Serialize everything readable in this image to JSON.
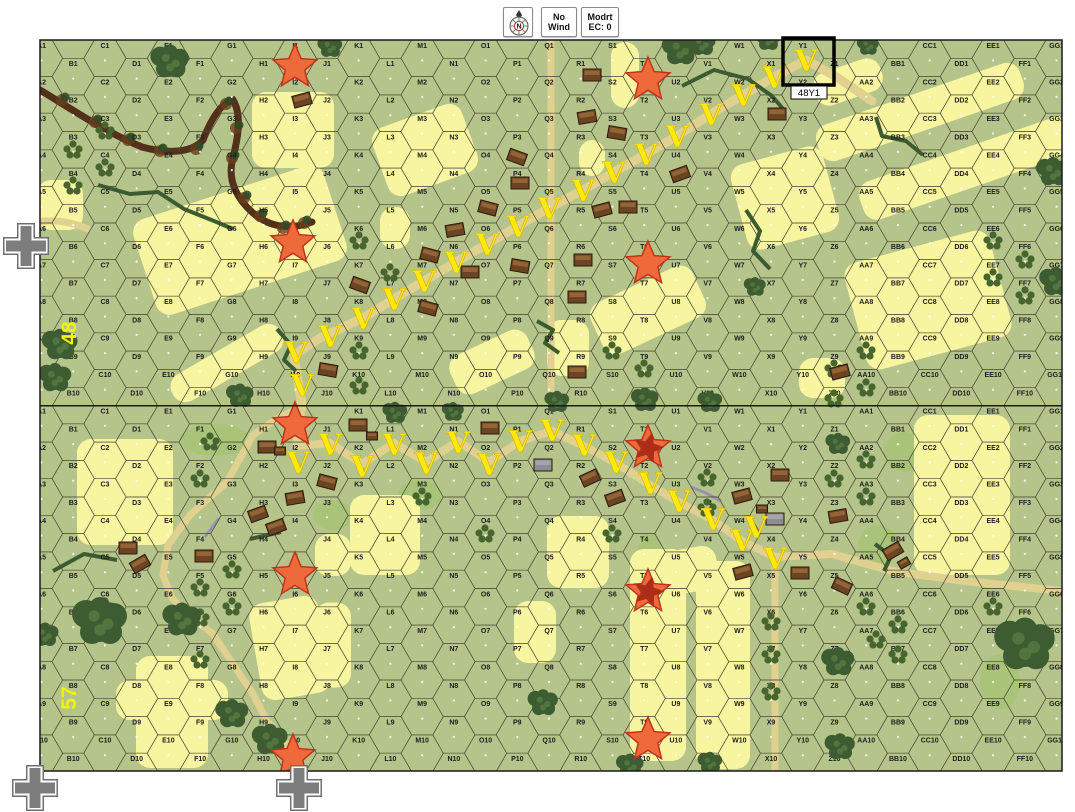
{
  "toolbar": {
    "compass_letter": "N",
    "wind": [
      "No",
      "Wind"
    ],
    "ec": [
      "Modrt",
      "EC: 0"
    ]
  },
  "map": {
    "columns": [
      "A",
      "B",
      "C",
      "D",
      "E",
      "F",
      "G",
      "H",
      "I",
      "J",
      "K",
      "L",
      "M",
      "N",
      "O",
      "P",
      "Q",
      "R",
      "S",
      "T",
      "U",
      "V",
      "W",
      "X",
      "Y",
      "Z",
      "AA",
      "BB",
      "CC",
      "DD",
      "EE",
      "FF",
      "GG"
    ],
    "rows_per_board": 10,
    "boards": [
      {
        "number": "48",
        "top": 40,
        "label_x": 76,
        "label_y": 333
      },
      {
        "number": "57",
        "top": 405.5,
        "label_x": 76,
        "label_y": 698
      }
    ],
    "geometry": {
      "left": 40,
      "col_spacing": 31.72,
      "row_height": 36.6,
      "hex_half_w": 21.15,
      "hex_half_h": 18.3,
      "width": 1022,
      "board_height": 366,
      "total_height": 731
    }
  },
  "selection": {
    "hex": "Y1",
    "label": "48Y1",
    "x": 783,
    "y": 38,
    "w": 51,
    "h": 47,
    "label_x": 791,
    "label_y": 86,
    "label_w": 36,
    "label_h": 13
  },
  "colors": {
    "page": "#ffffff",
    "base": "#b5c48a",
    "grid": "#4c4c38",
    "hex_label": "#1c1c1c",
    "grain": "#f8f5a0",
    "road": "#e0d191",
    "meadow": "#a9c478",
    "woods_dark": "#3e5c32",
    "woods_light": "#587c42",
    "orchard": "#47652f",
    "stream": "#3a5c30",
    "gully": "#53301a",
    "wall": "#9a93b0",
    "building": "#6b4423",
    "building_dark": "#2e1a0c",
    "building_roof": "#9a6a38",
    "building_gray": "#8c8c94",
    "star_fill": "#ef6a3a",
    "star_stroke": "#c2321c",
    "star_inner": "#a52815",
    "vee": "#ffe908",
    "board_label": "#f2f400",
    "selection": "#000000",
    "cross_gray": "#7d7d7d"
  },
  "terrain": {
    "fields": [
      {
        "x": 240,
        "y": 240,
        "w": 200,
        "h": 100,
        "r": -18
      },
      {
        "x": 227,
        "y": 363,
        "w": 125,
        "h": 30,
        "r": -30
      },
      {
        "x": 293,
        "y": 130,
        "w": 82,
        "h": 76,
        "r": 0
      },
      {
        "x": 60,
        "y": 205,
        "w": 46,
        "h": 50,
        "r": 0
      },
      {
        "x": 625,
        "y": 75,
        "w": 28,
        "h": 66,
        "r": 0
      },
      {
        "x": 425,
        "y": 150,
        "w": 95,
        "h": 72,
        "r": -20
      },
      {
        "x": 920,
        "y": 112,
        "w": 215,
        "h": 38,
        "r": -19
      },
      {
        "x": 968,
        "y": 168,
        "w": 225,
        "h": 40,
        "r": -19
      },
      {
        "x": 848,
        "y": 82,
        "w": 70,
        "h": 34,
        "r": -19
      },
      {
        "x": 928,
        "y": 300,
        "w": 150,
        "h": 110,
        "r": -15
      },
      {
        "x": 785,
        "y": 198,
        "w": 95,
        "h": 88,
        "r": -15
      },
      {
        "x": 648,
        "y": 310,
        "w": 112,
        "h": 56,
        "r": -25
      },
      {
        "x": 492,
        "y": 362,
        "w": 85,
        "h": 42,
        "r": -25
      },
      {
        "x": 568,
        "y": 348,
        "w": 42,
        "h": 56,
        "r": 0
      },
      {
        "x": 592,
        "y": 158,
        "w": 26,
        "h": 36,
        "r": 0
      },
      {
        "x": 822,
        "y": 378,
        "w": 46,
        "h": 40,
        "r": 0
      },
      {
        "x": 395,
        "y": 228,
        "w": 30,
        "h": 42,
        "r": 0
      },
      {
        "x": 125,
        "y": 492,
        "w": 96,
        "h": 106,
        "r": 0
      },
      {
        "x": 658,
        "y": 655,
        "w": 56,
        "h": 212,
        "r": 0
      },
      {
        "x": 723,
        "y": 665,
        "w": 54,
        "h": 208,
        "r": 0
      },
      {
        "x": 680,
        "y": 572,
        "w": 76,
        "h": 44,
        "r": -10
      },
      {
        "x": 290,
        "y": 648,
        "w": 70,
        "h": 98,
        "r": -10
      },
      {
        "x": 172,
        "y": 712,
        "w": 72,
        "h": 112,
        "r": 0
      },
      {
        "x": 172,
        "y": 700,
        "w": 112,
        "h": 40,
        "r": 0
      },
      {
        "x": 385,
        "y": 535,
        "w": 70,
        "h": 80,
        "r": 0
      },
      {
        "x": 333,
        "y": 555,
        "w": 36,
        "h": 42,
        "r": 0
      },
      {
        "x": 578,
        "y": 552,
        "w": 62,
        "h": 72,
        "r": 0
      },
      {
        "x": 962,
        "y": 495,
        "w": 96,
        "h": 160,
        "r": 0
      },
      {
        "x": 535,
        "y": 632,
        "w": 42,
        "h": 62,
        "r": 0
      },
      {
        "x": 333,
        "y": 645,
        "w": 36,
        "h": 85,
        "r": 0
      }
    ],
    "meadows": [
      [
        215,
        440,
        70,
        32
      ],
      [
        333,
        515,
        40,
        30
      ],
      [
        420,
        495,
        45,
        30
      ],
      [
        650,
        570,
        30,
        75
      ],
      [
        905,
        452,
        42,
        40
      ],
      [
        878,
        545,
        40,
        40
      ],
      [
        1000,
        682,
        40,
        55
      ]
    ],
    "roads": [
      {
        "d": "M302,406 L294,355 L320,338 L363,318 L394,299 L424,281 L456,262 L487,244 L518,226 L549,208 L583,190 L614,172 L646,154 L677,136 L711,114 L743,95 L774,77 L806,60 L838,78 L872,101",
        "w": 9
      },
      {
        "d": "M551,40 L551,406",
        "w": 7
      },
      {
        "d": "M38,222 Q62,218 88,229",
        "w": 7
      },
      {
        "d": "M302,406 L296,446 L330,443 L362,464 L394,443 L426,462 L458,441 L489,462 L520,441 L552,431 L584,446 L616,463 L650,485 L679,502 L713,520 L742,541 L775,557 L832,554 L892,571 L965,581 L1062,591",
        "w": 8
      },
      {
        "d": "M302,406 L275,420 L253,435 L227,482 L190,515 L168,545 L163,575 L172,598 L185,612 L213,634 L237,670 L253,694 L267,721 L290,748 L303,770",
        "w": 7
      },
      {
        "d": "M775,557 L775,771",
        "w": 7
      }
    ],
    "gully": "M40,90 C70,108 105,132 142,147 C168,154 192,153 203,140 C210,122 220,103 233,100 C243,116 237,142 232,162 C228,182 238,200 253,213 C268,226 288,231 312,222",
    "gully_trees": [
      [
        62,
        100
      ],
      [
        95,
        122
      ],
      [
        128,
        140
      ],
      [
        160,
        151
      ],
      [
        196,
        149
      ],
      [
        226,
        104
      ],
      [
        236,
        128
      ],
      [
        232,
        158
      ],
      [
        244,
        198
      ],
      [
        260,
        216
      ],
      [
        283,
        228
      ],
      [
        304,
        223
      ]
    ],
    "streams": [
      "M98,185 L130,194 L158,192 L184,209 L214,221 L233,229",
      "M682,86 L714,70 L748,79 L772,96 L784,110",
      "M746,210 L760,231 L753,251 L770,269",
      "M537,321 L553,330 L545,343 L559,353",
      "M277,329 L291,345 L284,360 L296,371",
      "M876,117 L882,136 L906,141 L923,155",
      "M53,571 L84,554 L117,560",
      "M250,539 L281,532",
      "M875,544 L891,556 L884,571"
    ],
    "walls": [
      "M205,537 L219,518",
      "M691,487 L706,493 L721,501"
    ],
    "woods": [
      [
        170,
        62,
        14
      ],
      [
        330,
        47,
        9
      ],
      [
        680,
        50,
        13
      ],
      [
        702,
        44,
        10
      ],
      [
        768,
        40,
        9
      ],
      [
        868,
        46,
        8
      ],
      [
        60,
        345,
        13
      ],
      [
        55,
        378,
        12
      ],
      [
        240,
        396,
        10
      ],
      [
        557,
        402,
        9
      ],
      [
        645,
        400,
        10
      ],
      [
        710,
        402,
        9
      ],
      [
        755,
        287,
        8
      ],
      [
        1053,
        172,
        12
      ],
      [
        1056,
        282,
        12
      ],
      [
        100,
        622,
        20
      ],
      [
        182,
        620,
        14
      ],
      [
        232,
        714,
        12
      ],
      [
        270,
        740,
        13
      ],
      [
        45,
        635,
        10
      ],
      [
        838,
        444,
        9
      ],
      [
        395,
        413,
        9
      ],
      [
        453,
        412,
        8
      ],
      [
        543,
        703,
        11
      ],
      [
        630,
        766,
        10
      ],
      [
        710,
        763,
        9
      ],
      [
        838,
        662,
        12
      ],
      [
        840,
        747,
        11
      ],
      [
        1025,
        645,
        22
      ]
    ],
    "orchards": [
      [
        105,
        131
      ],
      [
        73,
        150
      ],
      [
        105,
        168
      ],
      [
        73,
        186
      ],
      [
        359,
        241
      ],
      [
        390,
        273
      ],
      [
        359,
        351
      ],
      [
        359,
        386
      ],
      [
        612,
        351
      ],
      [
        644,
        369
      ],
      [
        993,
        241
      ],
      [
        1025,
        260
      ],
      [
        993,
        278
      ],
      [
        1025,
        296
      ],
      [
        866,
        351
      ],
      [
        834,
        369
      ],
      [
        866,
        388
      ],
      [
        834,
        399
      ],
      [
        210,
        442
      ],
      [
        200,
        479
      ],
      [
        200,
        588
      ],
      [
        232,
        570
      ],
      [
        232,
        607
      ],
      [
        105,
        607
      ],
      [
        200,
        618
      ],
      [
        200,
        660
      ],
      [
        422,
        497
      ],
      [
        485,
        534
      ],
      [
        612,
        534
      ],
      [
        707,
        478
      ],
      [
        707,
        508
      ],
      [
        771,
        622
      ],
      [
        771,
        655
      ],
      [
        771,
        692
      ],
      [
        866,
        460
      ],
      [
        834,
        479
      ],
      [
        866,
        497
      ],
      [
        866,
        607
      ],
      [
        898,
        625
      ],
      [
        876,
        640
      ],
      [
        898,
        655
      ],
      [
        993,
        607
      ]
    ],
    "buildings": [
      [
        302,
        100,
        -15,
        0
      ],
      [
        360,
        285,
        20,
        0
      ],
      [
        328,
        370,
        10,
        0
      ],
      [
        428,
        308,
        15,
        0
      ],
      [
        430,
        255,
        15,
        0
      ],
      [
        455,
        230,
        -10,
        0
      ],
      [
        470,
        272,
        0,
        0
      ],
      [
        488,
        208,
        15,
        0
      ],
      [
        517,
        157,
        20,
        0
      ],
      [
        520,
        183,
        0,
        0
      ],
      [
        520,
        266,
        10,
        0
      ],
      [
        577,
        297,
        0,
        0
      ],
      [
        577,
        372,
        0,
        0
      ],
      [
        583,
        260,
        0,
        0
      ],
      [
        587,
        117,
        -10,
        0
      ],
      [
        592,
        75,
        0,
        0
      ],
      [
        602,
        210,
        -15,
        0
      ],
      [
        617,
        133,
        10,
        0
      ],
      [
        628,
        207,
        0,
        0
      ],
      [
        680,
        174,
        -20,
        0
      ],
      [
        777,
        114,
        0,
        0
      ],
      [
        840,
        372,
        -15,
        0
      ],
      [
        358,
        425,
        0,
        0
      ],
      [
        372,
        436,
        0,
        1
      ],
      [
        327,
        482,
        15,
        0
      ],
      [
        295,
        498,
        -10,
        0
      ],
      [
        128,
        548,
        0,
        0
      ],
      [
        140,
        564,
        -30,
        0
      ],
      [
        204,
        556,
        0,
        0
      ],
      [
        267,
        447,
        0,
        0
      ],
      [
        280,
        451,
        0,
        1
      ],
      [
        258,
        514,
        -20,
        0
      ],
      [
        276,
        527,
        -20,
        0
      ],
      [
        490,
        428,
        0,
        0
      ],
      [
        543,
        465,
        0,
        2
      ],
      [
        590,
        478,
        -25,
        0
      ],
      [
        615,
        498,
        -20,
        0
      ],
      [
        742,
        496,
        -15,
        0
      ],
      [
        762,
        509,
        0,
        1
      ],
      [
        775,
        519,
        0,
        2
      ],
      [
        780,
        475,
        0,
        0
      ],
      [
        838,
        516,
        -10,
        0
      ],
      [
        893,
        551,
        -30,
        0
      ],
      [
        904,
        563,
        -30,
        1
      ],
      [
        842,
        586,
        25,
        0
      ],
      [
        743,
        572,
        -15,
        0
      ],
      [
        800,
        573,
        0,
        0
      ]
    ]
  },
  "markers": {
    "stars": [
      {
        "x": 295,
        "y": 67,
        "double": false
      },
      {
        "x": 648,
        "y": 80,
        "double": false
      },
      {
        "x": 293,
        "y": 243,
        "double": false
      },
      {
        "x": 648,
        "y": 264,
        "double": false
      },
      {
        "x": 295,
        "y": 425,
        "double": false
      },
      {
        "x": 648,
        "y": 448,
        "double": true
      },
      {
        "x": 295,
        "y": 575,
        "double": false
      },
      {
        "x": 648,
        "y": 592,
        "double": true
      },
      {
        "x": 293,
        "y": 757,
        "double": false
      },
      {
        "x": 648,
        "y": 740,
        "double": false
      }
    ],
    "vee_letter": "V",
    "vees": [
      [
        302,
        385
      ],
      [
        296,
        352
      ],
      [
        330,
        336
      ],
      [
        363,
        318
      ],
      [
        394,
        299
      ],
      [
        424,
        281
      ],
      [
        456,
        262
      ],
      [
        487,
        244
      ],
      [
        518,
        226
      ],
      [
        549,
        208
      ],
      [
        583,
        190
      ],
      [
        614,
        172
      ],
      [
        646,
        154
      ],
      [
        677,
        136
      ],
      [
        711,
        114
      ],
      [
        743,
        95
      ],
      [
        774,
        77
      ],
      [
        806,
        60
      ],
      [
        298,
        462
      ],
      [
        330,
        444
      ],
      [
        362,
        466
      ],
      [
        394,
        444
      ],
      [
        426,
        463
      ],
      [
        458,
        442
      ],
      [
        489,
        464
      ],
      [
        520,
        441
      ],
      [
        552,
        430
      ],
      [
        584,
        445
      ],
      [
        616,
        462
      ],
      [
        650,
        483
      ],
      [
        679,
        501
      ],
      [
        713,
        519
      ],
      [
        742,
        540
      ],
      [
        756,
        527
      ],
      [
        775,
        558
      ]
    ],
    "crosses": [
      [
        26,
        246
      ],
      [
        35,
        788
      ],
      [
        299,
        788
      ]
    ]
  }
}
